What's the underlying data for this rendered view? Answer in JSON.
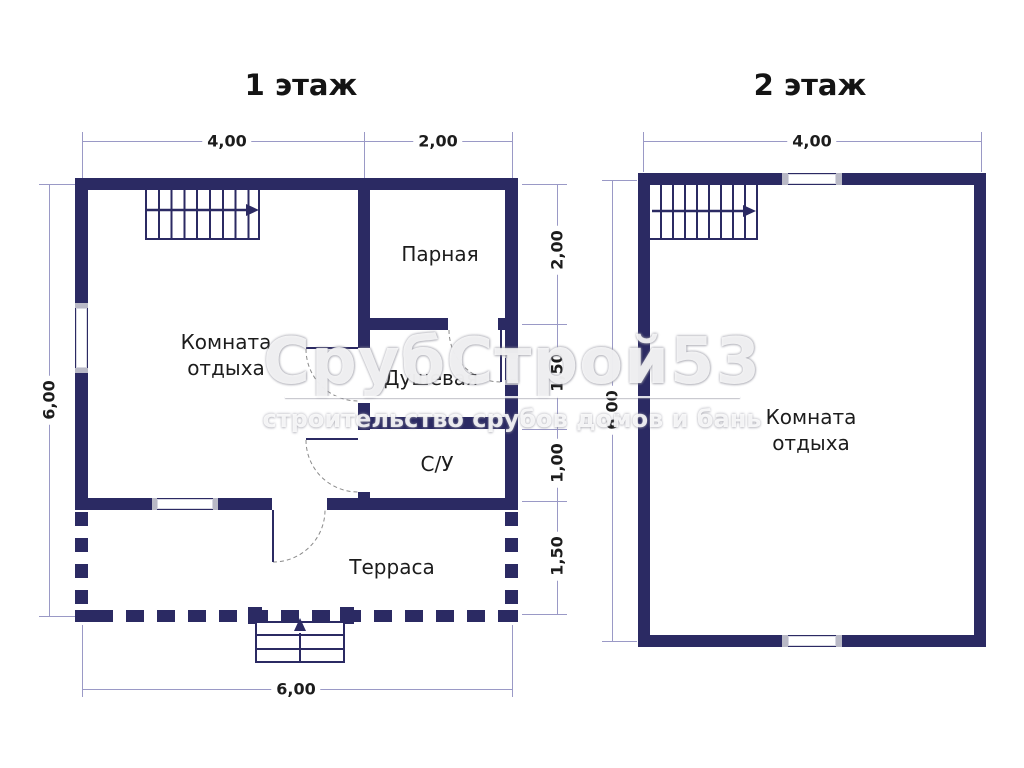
{
  "colors": {
    "wall": "#2b2a63",
    "dim_line": "#9a99c6",
    "text": "#1c1c1c",
    "window_cap": "#b9b9c6",
    "arc": "#8a8a8a"
  },
  "watermark": {
    "brand": "СрубСтрой53",
    "tagline": "строительство срубов домов и бань"
  },
  "plan1": {
    "title": "1 этаж",
    "rooms": {
      "rest": "Комната отдыха",
      "steam": "Парная",
      "shower": "Душевая",
      "wc": "С/У",
      "terrace": "Терраса"
    },
    "dims": {
      "top_left": "4,00",
      "top_right": "2,00",
      "left": "6,00",
      "right_1": "2,00",
      "right_2": "1,50",
      "right_3": "1,00",
      "right_4": "1,50",
      "bottom": "6,00"
    }
  },
  "plan2": {
    "title": "2 этаж",
    "rooms": {
      "rest": "Комната отдыха"
    },
    "dims": {
      "top": "4,00",
      "left": "6,00"
    }
  }
}
